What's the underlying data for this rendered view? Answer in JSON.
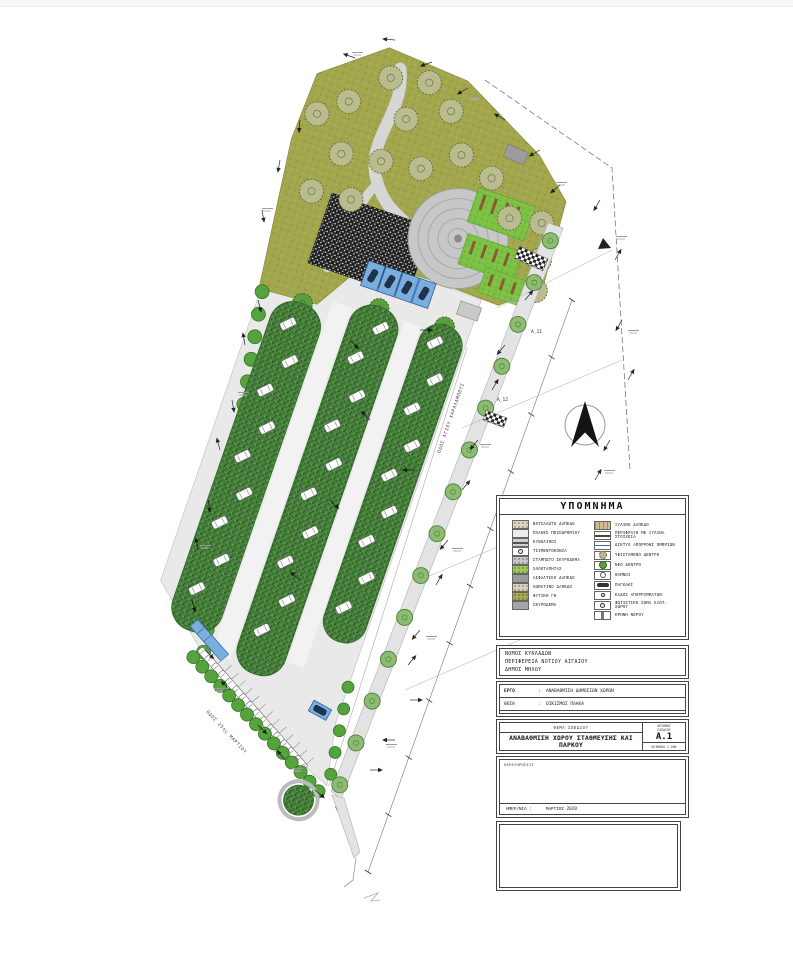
{
  "plan": {
    "roads": {
      "east": "ΟΔΟΣ ΑΓΙΟΥ ΧΑΡΑΛΑΜΠΟΥΣ",
      "south": "ΟΔΟΣ 25ης ΜΑΡΤΙΟΥ"
    },
    "section_markers": [
      "Α_11",
      "Α_12"
    ],
    "colors": {
      "park_ground": "#a2a64c",
      "lawn": "#7cc144",
      "planting_strip": "#4a8440",
      "hedge": "#55a33c",
      "paving": "#e9e9e9",
      "accessible_blue": "#7aaedd",
      "bench_brown": "#8a5a33"
    }
  },
  "legend": {
    "title": "ΥΠΟΜΝΗΜΑ",
    "left": [
      {
        "swatch": "pebble",
        "label": "ΒΟΤΣΑΛΩΤΟ ΔΑΠΕΔΟ"
      },
      {
        "swatch": "plain",
        "label": "ΠΛΑΚΕΣ ΠΕΖΟΔΡΟΜΙΟΥ"
      },
      {
        "swatch": "cobble",
        "label": "ΚΥΒΟΛΙΘΟΙ"
      },
      {
        "swatch": "light",
        "label": "ΤΣΙΜΕΝΤΟΚΟΝΙΑ"
      },
      {
        "swatch": "stamped",
        "label": "ΣΤΑΜΠΩΤΟ ΣΚΥΡΟΔΕΜΑ"
      },
      {
        "swatch": "grass",
        "label": "ΧΛΟΟΤΑΠΗΤΑΣ"
      },
      {
        "swatch": "asphalt",
        "label": "ΑΣΦΑΛΤΙΚΟ ΔΑΠΕΔΟ"
      },
      {
        "swatch": "earth",
        "label": "ΧΩΜΑΤΙΝΟ ΔΑΠΕΔΟ"
      },
      {
        "swatch": "soil",
        "label": "ΦΥΤΙΚΗ ΓΗ"
      },
      {
        "swatch": "concrete",
        "label": "ΣΚΥΡΟΔΕΜΑ"
      }
    ],
    "right": [
      {
        "swatch": "wood",
        "label": "ΞΥΛΙΝΟ ΔΑΠΕΔΟ"
      },
      {
        "swatch": "fence",
        "label": "ΠΕΡΙΦΡΑΞΗ ΜΕ ΞΥΛΙΝΑ ΣΤΟΙΧΕΙΑ"
      },
      {
        "swatch": "drain",
        "label": "ΔΙΚΤΥΟ ΑΠΟΡΡΟΗΣ ΟΜΒΡΙΩΝ"
      },
      {
        "swatch": "extree",
        "label": "ΥΦΙΣΤΑΜΕΝΟ ΔΕΝΤΡΟ"
      },
      {
        "swatch": "newtree",
        "label": "ΝΕΟ ΔΕΝΤΡΟ"
      },
      {
        "swatch": "shrub",
        "label": "ΘΑΜΝΟΙ"
      },
      {
        "swatch": "bench",
        "label": "ΠΑΓΚΑΚΙ"
      },
      {
        "swatch": "bin",
        "label": "ΚΑΔΟΣ ΑΠΟΡΡΙΜΜΑΤΩΝ"
      },
      {
        "swatch": "light",
        "label": "ΦΩΤΙΣΤΙΚΟ ΣΩΜΑ ΕΞΩΤ. ΧΩΡΟΥ"
      },
      {
        "swatch": "fountain",
        "label": "ΚΡΗΝΗ ΝΕΡΟΥ"
      }
    ]
  },
  "title_block": {
    "municipality_lines": [
      "ΝΟΜΟΣ ΚΥΚΛΑΔΩΝ",
      "ΠΕΡΙΦΕΡΕΙΑ ΝΟΤΙΟΥ ΑΙΓΑΙΟΥ",
      "ΔΗΜΟΣ ΜΗΛΟΥ"
    ],
    "project": {
      "label": "ΕΡΓΟ",
      "colon": ":",
      "value": "ΑΝΑΒΑΘΜΙΣΗ ΔΗΜΟΣΙΩΝ ΧΩΡΩΝ"
    },
    "location": {
      "label": "ΘΕΣΗ",
      "colon": ":",
      "value": "ΟΙΚΙΣΜΟΣ ΠΛΑΚΑ"
    },
    "designer": {
      "label": "ΜΕΛΕΤΗΤΗΣ :"
    },
    "sheet": {
      "header": "ΘΕΜΑ ΣΧΕΔΙΟΥ",
      "title": "ΑΝΑΒΑΘΜΙΣΗ ΧΩΡΟΥ ΣΤΑΘΜΕΥΣΗΣ ΚΑΙ ΠΑΡΚΟΥ",
      "number_label_1": "ΑΡΙΘΜΟΣ",
      "number_label_2": "ΣΧΕΔΙΟΥ",
      "number": "Α.1",
      "scale": "ΚΛΙΜΑΚΑ 1:200"
    },
    "notes_label": "ΠΑΡΑΤΗΡΗΣΕΙΣ",
    "date_label": "ΗΜΕΡ/ΝΙΑ :",
    "date_value": "ΜΑΡΤΙΟΣ 2020"
  }
}
